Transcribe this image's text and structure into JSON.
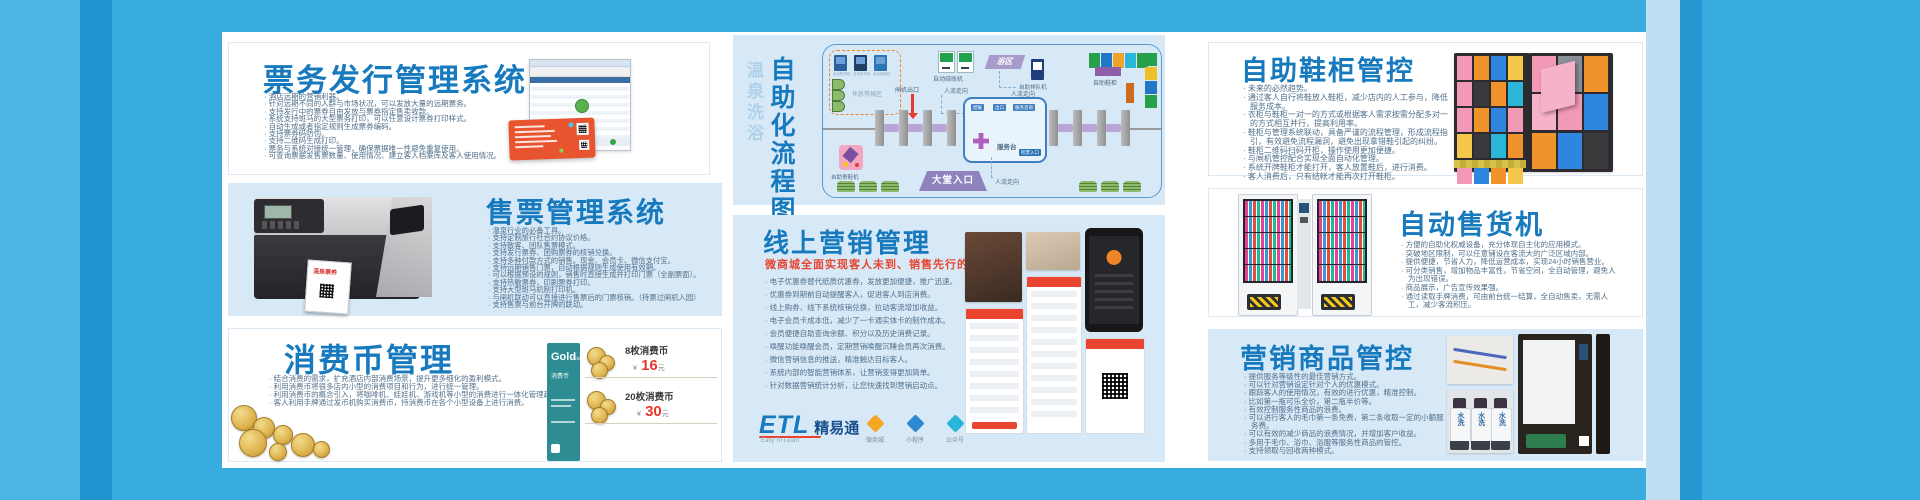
{
  "frame": {
    "blue": "#38abdf",
    "accent_blue": "#1779be",
    "panel_blue": "#d7e9f7",
    "red": "#e8392f"
  },
  "ticket_issuing": {
    "title": "票务发行管理系统",
    "bullets": [
      "酒店远期的营销利器。",
      "针对远期不同的人群与市场状况，可以发放大量的远期票务。",
      "支持发行中的票券自由发放与票券指定售卖收款。",
      "系统支持斑马的大型票务打印，可以任意设计票券打印样式。",
      "自动生成或者指定规则生成票券编码。",
      "支持票券码防伪。",
      "支持二维码生成打印。",
      "票务与系统对接统一管理，确保票据唯一性避免重复使用。",
      "可查询票据发售票数量、使用情况、建立客人档案库及客人使用情况。"
    ]
  },
  "ticket_sales": {
    "title": "售票管理系统",
    "printer_label": "温泉票券",
    "bullets": [
      "温泉行业的必备工具。",
      "支持定制旅行社合约协议价格。",
      "支持散客、团队售票模式。",
      "支持发行票券、团购票券的核销兑换。",
      "支持多种付款方式的销售。现金、会员卡、微信支付宝。",
      "支持远期销售门票，自动根据规则生成使用有效期。",
      "可以根据预设的规则，销售时直接生成并打印门票（全副票面）。",
      "支持热敏票券，印刷票券打印。",
      "支持大型斑马机制打印机。",
      "与闸机联动可以直接进行售票后的门票核销。（持票过闸机入园）",
      "支持售票与前台开牌的联动。"
    ]
  },
  "coin_mgmt": {
    "title": "消费币管理",
    "bullets": [
      "结合消费的需求，扩充酒店内部消费场景，提升更多细化的盈利模式。",
      "利用消费币将很多店内小型的消费项目和行为，进行统一管理。",
      "利用消费币的概念引入，将咖啡机、娃娃机、游戏机等小型的消费进行一体化管理起来。",
      "客人利用手牌通过发币机购买消费币，持消费币在各个小型设备上进行消费。"
    ],
    "card": {
      "brand": "Gold",
      "brand_suffix": "Coins",
      "subtitle": "消费币"
    },
    "items": [
      {
        "qty": "8枚消费币",
        "currency": "¥",
        "price": "16",
        "unit": "元"
      },
      {
        "qty": "20枚消费币",
        "currency": "¥",
        "price": "30",
        "unit": "元"
      }
    ]
  },
  "flow": {
    "title_vertical": "自助化流程图",
    "subtitle_vertical": "温泉洗浴",
    "rest_area": {
      "label": "休息等候区",
      "machines": [
        "自动售货机",
        "自动售币机",
        "自动咖啡机"
      ]
    },
    "labels": {
      "checkout_machines": "自动结账机",
      "flow_direction": "人流走向",
      "gate_exit": "闸机出口",
      "service_desk": "服务台",
      "service_chips": [
        "结账",
        "出口",
        "服务咨询"
      ],
      "ticket_entry": "检票入口",
      "lobby_entry": "大堂入口",
      "shoe_deposit": "自助寄鞋机",
      "bath_area": "浴区",
      "queue_machine": "自助排队机",
      "shoe_lockers": "自助鞋柜"
    },
    "locker_row_colors": [
      "#27a04c",
      "#2176c7",
      "#f0a32b",
      "#29b6d8",
      "#27a04c"
    ],
    "locker_col_colors": [
      "#27a04c",
      "#f0c02b",
      "#2176c7",
      "#27a04c"
    ]
  },
  "online_marketing": {
    "title": "线上营销管理",
    "subtitle": "微商城全面实现客人未到、销售先行的理念",
    "bullets": [
      "电子优惠券替代纸质优惠券，发放更加便捷，推广迅速。",
      "优惠券到期前自动提醒客人，促进客人到店消费。",
      "线上购券、线下系统核销兑换，拉动客流增加收益。",
      "电子会员卡成本低，减少了一卡通实体卡的制作成本。",
      "会员便捷自助查询余额、积分以及历史消费记录。",
      "唤醒功能唤醒会员，定期营销唤醒沉睡会员再次消费。",
      "微信营销信息的推送，精准触达目标客人。",
      "系统内部的智能营销体系，让营销变得更加简单。",
      "针对数据营销统计分析，让您快速找到营销启动点。"
    ],
    "logo": {
      "name": "ETL",
      "cn_name": "精易通",
      "tagline": "Easy To Learn"
    },
    "features": [
      {
        "label": "微商城",
        "color": "#f5a623"
      },
      {
        "label": "小程序",
        "color": "#2f89d0"
      },
      {
        "label": "公众号",
        "color": "#29b6d8"
      }
    ]
  },
  "shoe_cabinet": {
    "title": "自助鞋柜管控",
    "bullets": [
      "未来的必然趋势。",
      "通过客人自行将鞋放入鞋柜，减少店内的人工参与，降低服务成本。",
      "衣柜与鞋柜一对一的方式或根据客人需求按需分配多对一的方式相互并行，提高利用率。",
      "鞋柜与管理系统联动，具备严谨的流程管理，形成流程指引，有效避免流程漏洞，避免出现拿错鞋引起的纠纷。",
      "鞋柜二维码扫码开柜，操作使用更加便捷。",
      "与闸机管控配合实现全面自动化管理。",
      "系统开牌鞋柜才能打开，客人放置鞋后，进行消费。",
      "客人消费后，只有结帐才能再次打开鞋柜。"
    ],
    "photo1_colors": [
      "#f29ab5",
      "#f0932b",
      "#2e86de",
      "#f5c84c",
      "#f29ab5",
      "#3a3a3c",
      "#f0932b",
      "#29b6d8",
      "#f29ab5",
      "#f0932b",
      "#2e86de",
      "#f29ab5",
      "#f5c84c",
      "#3a3a3c",
      "#29b6d8",
      "#f0932b",
      "#f29ab5",
      "#2e86de",
      "#f0932b",
      "#f5c84c"
    ],
    "photo2_colors": [
      "#f29ab5",
      "#8a8f98",
      "#f0932b",
      "#f6b2c8",
      "#f29ab5",
      "#2e86de",
      "#f0932b",
      "#2e86de",
      "#3a3a3c"
    ]
  },
  "vending": {
    "title": "自动售货机",
    "bullets": [
      "方便的自助化权威设备，充分体现自主化的应用模式。",
      "突破地区限制，可以任意铺设在客流大的广泛区域内部。",
      "提供便捷，节省人力，降低运营成本，实现24小时销售营业。",
      "可分类销售，增加物品丰富性，节省空间，全自动管理，避免人为出现错误。",
      "商品展示，广告宣传效果强。",
      "通过读取手牌消费，可由前台统一结算，全自动售卖，无需人工，减少客流积压。"
    ]
  },
  "goods_control": {
    "title": "营销商品管控",
    "bottle_label": "水洗",
    "bullets": [
      "提供服务等级性的最佳营销方式。",
      "可以针对营销设定针对个人的优惠模式。",
      "跟踪客人的使用情况，有效的进行优惠，精准控制。",
      "比如第一瓶可乐全价，第二瓶半价等。",
      "有效控制服务性商品的浪费。",
      "可以进行客人的毛巾第一条免费，第二条收取一定的小额服务费。",
      "可以有效的减少商品的浪费情况，并增加客户收益。",
      "多用于毛巾、浴巾、浴服等服务性商品的管控。",
      "支持领取与回收两种模式。"
    ]
  }
}
